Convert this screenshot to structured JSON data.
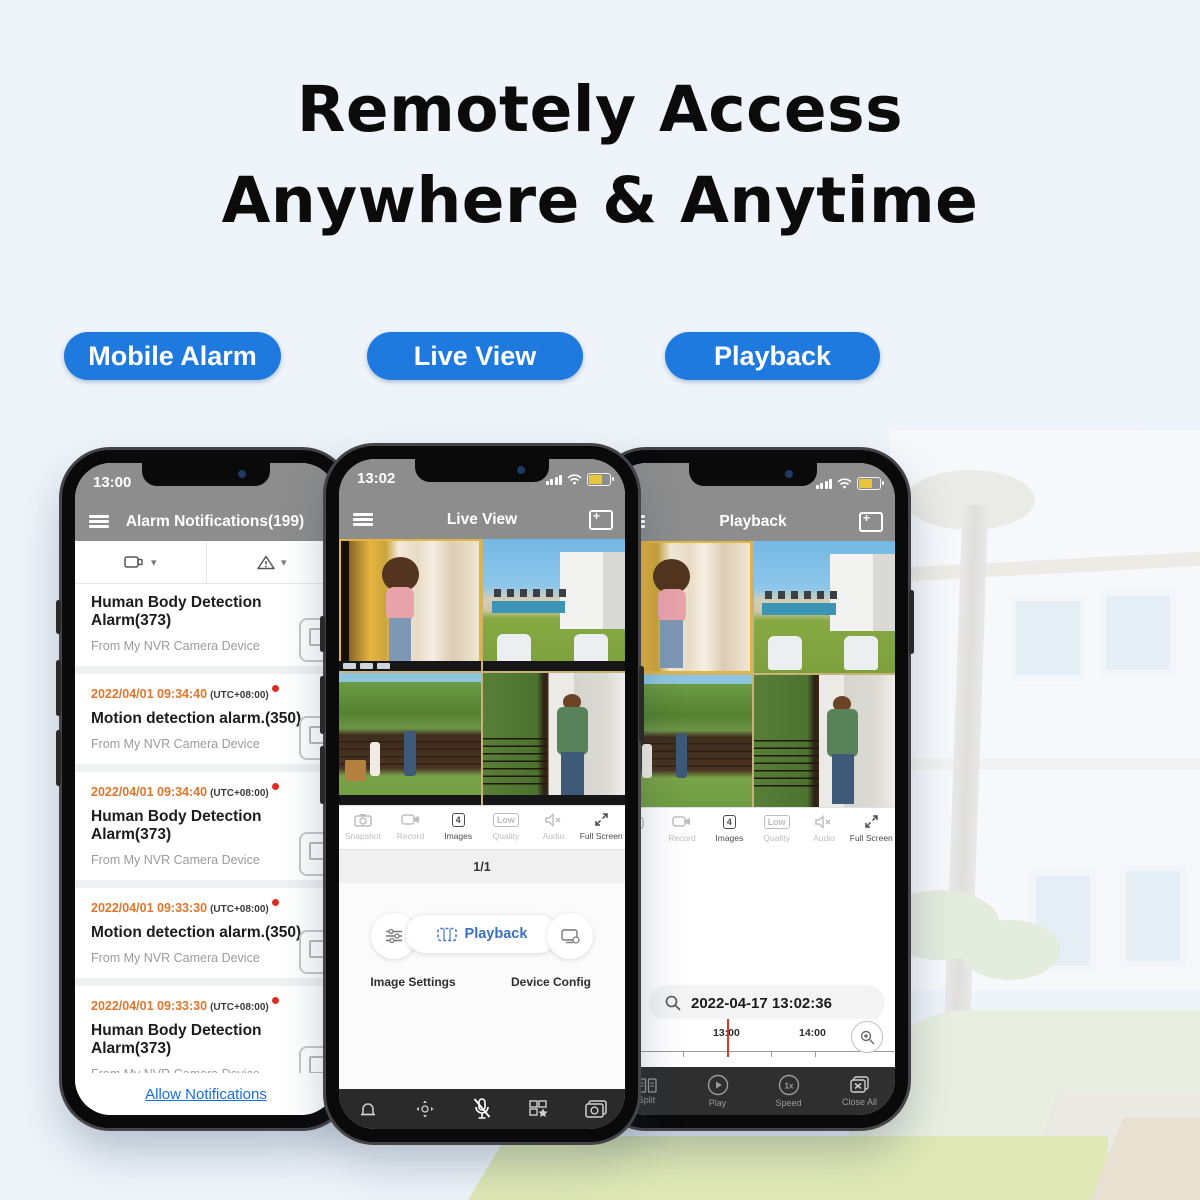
{
  "page": {
    "headline_line1": "Remotely Access",
    "headline_line2": "Anywhere & Anytime"
  },
  "colors": {
    "accent_blue": "#1f7ae0",
    "header_gray": "#8d8d8d",
    "timestamp_orange": "#e0762c",
    "alert_red": "#e02b20",
    "link_blue": "#1a6fe0",
    "toolbar_dark": "#2a2a2b",
    "battery_yellow": "#e9c53e",
    "timeline_cursor_red": "#e03428"
  },
  "buttons": [
    {
      "label": "Mobile Alarm"
    },
    {
      "label": "Live View"
    },
    {
      "label": "Playback"
    }
  ],
  "alarm_phone": {
    "status_time": "13:00",
    "header_title": "Alarm Notifications(199)",
    "notifications": [
      {
        "timestamp": "",
        "tz": "",
        "title": "Human Body Detection Alarm(373)",
        "source": "From My NVR Camera Device"
      },
      {
        "timestamp": "2022/04/01 09:34:40",
        "tz": "(UTC+08:00)",
        "title": "Motion detection alarm.(350)",
        "source": "From My NVR Camera Device"
      },
      {
        "timestamp": "2022/04/01 09:34:40",
        "tz": "(UTC+08:00)",
        "title": "Human Body Detection Alarm(373)",
        "source": "From My NVR Camera Device"
      },
      {
        "timestamp": "2022/04/01 09:33:30",
        "tz": "(UTC+08:00)",
        "title": "Motion detection alarm.(350)",
        "source": "From My NVR Camera Device"
      },
      {
        "timestamp": "2022/04/01 09:33:30",
        "tz": "(UTC+08:00)",
        "title": "Human Body Detection Alarm(373)",
        "source": "From My NVR Camera Device"
      },
      {
        "timestamp": "2022/04/01 09:32:37",
        "tz": "(UTC+08:00)",
        "title": "Motion detection alarm.(350)",
        "source": "From My NVR Camera Device"
      }
    ],
    "footer_link": "Allow Notifications"
  },
  "live_phone": {
    "status_time": "13:02",
    "header_title": "Live View",
    "controls": [
      {
        "label": "Snapshot"
      },
      {
        "label": "Record"
      },
      {
        "label": "Images",
        "badge": "4"
      },
      {
        "label": "Quality",
        "badge": "Low"
      },
      {
        "label": "Audio"
      },
      {
        "label": "Full Screen"
      }
    ],
    "page_indicator": "1/1",
    "quick_actions": {
      "left_label": "Image Settings",
      "center_label": "Playback",
      "right_label": "Device Config"
    }
  },
  "playback_phone": {
    "header_title": "Playback",
    "controls": [
      {
        "label": "Record"
      },
      {
        "label": "Images",
        "badge": "4"
      },
      {
        "label": "Quality",
        "badge": "Low"
      },
      {
        "label": "Audio"
      },
      {
        "label": "Full Screen"
      }
    ],
    "search_datetime": "2022-04-17 13:02:36",
    "timeline": {
      "labels": [
        "12:00",
        "13:00",
        "14:00"
      ],
      "cursor_at": "13:00"
    },
    "toolbar": [
      {
        "label": "Split"
      },
      {
        "label": "Play"
      },
      {
        "label": "Speed",
        "badge": "1x"
      },
      {
        "label": "Close All"
      }
    ]
  }
}
